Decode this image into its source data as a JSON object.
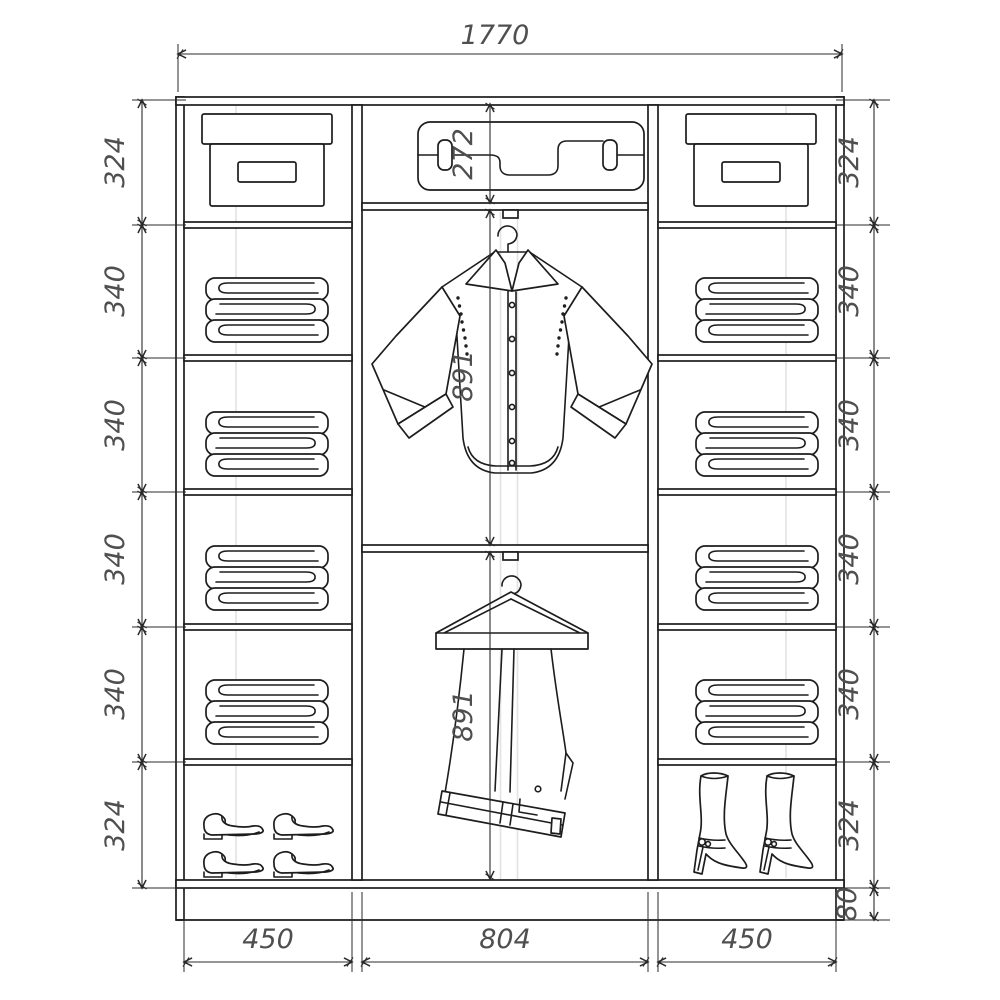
{
  "drawing": {
    "title": "Wardrobe interior elevation drawing",
    "units": "mm",
    "overall_width": "1770",
    "left_column": {
      "shelf_heights": [
        "324",
        "340",
        "340",
        "340",
        "340",
        "324"
      ]
    },
    "right_column": {
      "shelf_heights": [
        "324",
        "340",
        "340",
        "340",
        "340",
        "324"
      ],
      "plinth_height": "80"
    },
    "center_column": {
      "top_compartment_height": "272",
      "upper_hanging_height": "891",
      "lower_hanging_height": "891"
    },
    "section_widths": [
      "450",
      "804",
      "450"
    ],
    "icons": {
      "top_left": "storage-box",
      "top_center": "suitcase",
      "top_right": "storage-box",
      "left_shelves": "folded-clothes",
      "right_shelves": "folded-clothes",
      "center_upper": "shirt-on-hanger",
      "center_lower": "trousers-on-hanger",
      "bottom_left": "shoes",
      "bottom_right": "boots"
    },
    "colors": {
      "line": "#1c1c1c",
      "dim_text": "#4f4f4f",
      "background": "#ffffff"
    }
  }
}
